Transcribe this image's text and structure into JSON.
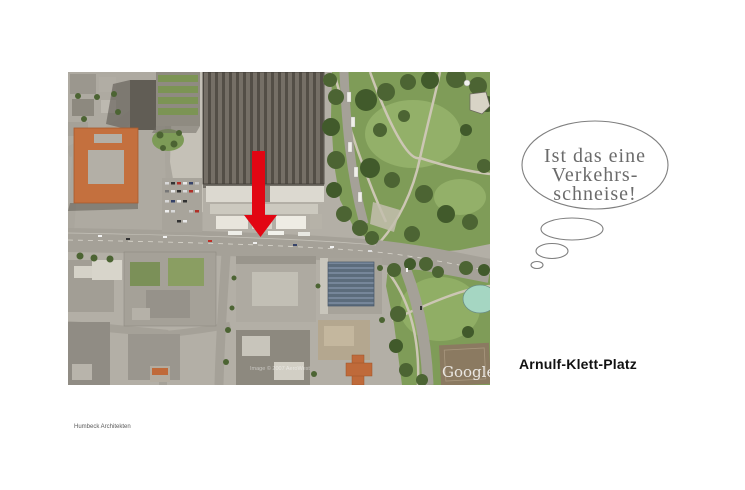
{
  "labels": {
    "place": "Arnulf-Klett-Platz",
    "credit": "Humbeck Architekten"
  },
  "thought_bubble": {
    "lines": [
      "Ist das eine",
      "Verkehrs-",
      "schneise!"
    ]
  },
  "map": {
    "watermark_provider": "Google",
    "watermark_copyright": "Image © 2007 AeroWest",
    "marker": "red-down-arrow",
    "marker_color": "#e20613"
  },
  "colors": {
    "background": "#ffffff",
    "bubble_outline": "#7f7f7f",
    "bubble_text": "#6b6b6b",
    "label_text": "#121212",
    "credit_text": "#5a5a5a"
  }
}
